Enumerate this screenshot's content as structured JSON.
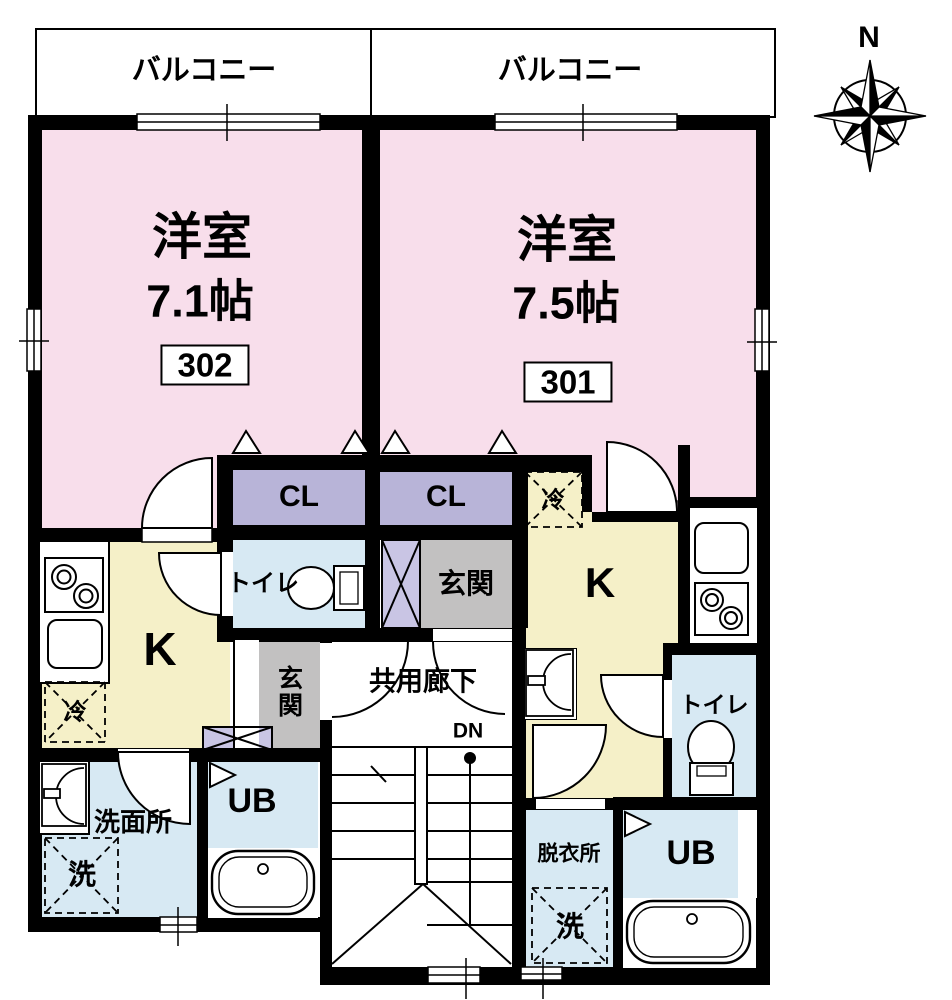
{
  "compass": {
    "north_label": "N"
  },
  "balconies": {
    "left": "バルコニー",
    "right": "バルコニー"
  },
  "common_area": {
    "corridor": "共用廊下",
    "stairs_down": "DN"
  },
  "unit_302": {
    "number": "302",
    "room_type": "洋室",
    "room_size": "7.1帖",
    "closet": "CL",
    "kitchen": "K",
    "fridge": "冷",
    "toilet": "トイレ",
    "entrance": "玄関",
    "washroom": "洗面所",
    "washer": "洗",
    "unit_bath": "UB"
  },
  "unit_301": {
    "number": "301",
    "room_type": "洋室",
    "room_size": "7.5帖",
    "closet": "CL",
    "kitchen": "K",
    "fridge": "冷",
    "toilet": "トイレ",
    "entrance": "玄関",
    "dressing_room": "脱衣所",
    "washer": "洗",
    "unit_bath": "UB"
  },
  "colors": {
    "room_pink": "#f8deeb",
    "kitchen_yellow": "#f5f0c8",
    "wet_blue": "#d7e9f3",
    "closet_purple": "#b8b4d8",
    "cabinet_purple": "#c9c5e4",
    "entrance_gray": "#c2c1c1",
    "wall": "#000000"
  }
}
